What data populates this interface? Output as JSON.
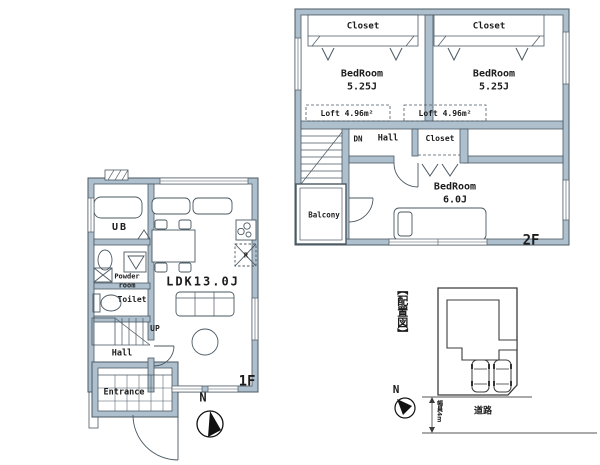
{
  "colors": {
    "wall_fill": "#aec0ce",
    "wall_line": "#4a5862",
    "ink": "#1c1c1c"
  },
  "floor2": {
    "label": "2F",
    "bedroom_left": {
      "name": "BedRoom",
      "size": "5.25J"
    },
    "bedroom_right": {
      "name": "BedRoom",
      "size": "5.25J"
    },
    "bedroom_main": {
      "name": "BedRoom",
      "size": "6.0J"
    },
    "closet_left": "Closet",
    "closet_right": "Closet",
    "closet_mid": "Closet",
    "loft_left": "Loft 4.96m²",
    "loft_right": "Loft 4.96m²",
    "hall": "Hall",
    "stairs": "DN",
    "balcony": "Balcony"
  },
  "floor1": {
    "label": "1F",
    "ldk": "LDK13.0J",
    "bath": "UB",
    "powder_room": "Powder room",
    "toilet": "Toilet",
    "hall": "Hall",
    "entrance": "Entrance",
    "stairs": "UP",
    "refrigerator": "R",
    "compass": "N"
  },
  "site_plan": {
    "title": "【配置図】",
    "road": "道路",
    "road_width": "幅員4m",
    "compass": "N"
  }
}
